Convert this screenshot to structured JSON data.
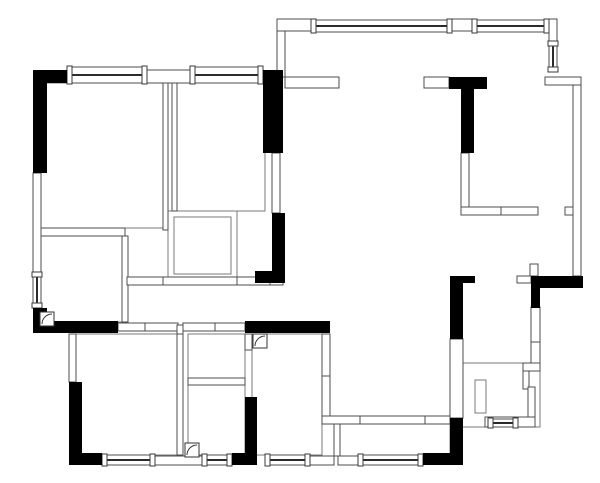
{
  "meta": {
    "type": "floor_plan",
    "description": "Black-and-white architectural apartment floor plan",
    "canvas_width": 600,
    "canvas_height": 483
  },
  "colors": {
    "background": "#ffffff",
    "solid_wall": "#000000",
    "partition_outline": "#4d4d4d",
    "room_outline": "#7a7a7a",
    "window_sash": "#2b2b2b",
    "door_line": "#333333"
  },
  "elements": {
    "solid_walls": [
      [
        33,
        70,
        34,
        13
      ],
      [
        33,
        70,
        14,
        103
      ],
      [
        263,
        70,
        20,
        83
      ],
      [
        272,
        213,
        13,
        70
      ],
      [
        255,
        271,
        30,
        12
      ],
      [
        449,
        77,
        38,
        12
      ],
      [
        461,
        89,
        13,
        64
      ],
      [
        33,
        308,
        14,
        25
      ],
      [
        33,
        321,
        85,
        12
      ],
      [
        245,
        321,
        85,
        12
      ],
      [
        69,
        382,
        13,
        83
      ],
      [
        69,
        453,
        33,
        12
      ],
      [
        232,
        453,
        24,
        12
      ],
      [
        245,
        397,
        12,
        68
      ],
      [
        423,
        453,
        40,
        12
      ],
      [
        450,
        418,
        13,
        47
      ],
      [
        450,
        276,
        13,
        63
      ],
      [
        463,
        276,
        12,
        7
      ],
      [
        531,
        276,
        52,
        12
      ],
      [
        531,
        288,
        9,
        20
      ]
    ],
    "partition_walls": [
      [
        147,
        70,
        43,
        13
      ],
      [
        33,
        173,
        8,
        99
      ],
      [
        277,
        19,
        34,
        12
      ],
      [
        452,
        19,
        20,
        12
      ],
      [
        549,
        19,
        8,
        22
      ],
      [
        545,
        77,
        36,
        8
      ],
      [
        573,
        85,
        8,
        191
      ],
      [
        565,
        207,
        8,
        8
      ],
      [
        277,
        31,
        8,
        46
      ],
      [
        285,
        77,
        54,
        11
      ],
      [
        424,
        77,
        25,
        11
      ],
      [
        461,
        153,
        8,
        54
      ],
      [
        461,
        207,
        40,
        8
      ],
      [
        501,
        207,
        37,
        8
      ],
      [
        272,
        153,
        8,
        60
      ],
      [
        450,
        339,
        13,
        79
      ],
      [
        163,
        83,
        5,
        147
      ],
      [
        172,
        83,
        5,
        128
      ],
      [
        41,
        228,
        84,
        8
      ],
      [
        122,
        236,
        6,
        86
      ],
      [
        127,
        277,
        36,
        8
      ],
      [
        163,
        277,
        74,
        8
      ],
      [
        237,
        277,
        33,
        8
      ],
      [
        270,
        277,
        13,
        8
      ],
      [
        118,
        323,
        27,
        8
      ],
      [
        145,
        323,
        33,
        8
      ],
      [
        183,
        323,
        32,
        8
      ],
      [
        215,
        323,
        30,
        8
      ],
      [
        177,
        325,
        6,
        17
      ],
      [
        177,
        334,
        6,
        121
      ],
      [
        69,
        334,
        7,
        48
      ],
      [
        188,
        378,
        57,
        7
      ],
      [
        245,
        334,
        7,
        16
      ],
      [
        322,
        334,
        8,
        42
      ],
      [
        322,
        376,
        8,
        42
      ],
      [
        322,
        416,
        38,
        8
      ],
      [
        360,
        416,
        65,
        8
      ],
      [
        425,
        416,
        25,
        8
      ],
      [
        334,
        424,
        6,
        32
      ],
      [
        155,
        456,
        47,
        9
      ],
      [
        310,
        456,
        24,
        9
      ],
      [
        338,
        456,
        20,
        9
      ],
      [
        531,
        307,
        9,
        35
      ],
      [
        531,
        342,
        9,
        23
      ],
      [
        523,
        363,
        17,
        8
      ],
      [
        523,
        371,
        6,
        18
      ],
      [
        528,
        387,
        7,
        30
      ],
      [
        485,
        417,
        50,
        10
      ],
      [
        530,
        264,
        8,
        12
      ],
      [
        517,
        276,
        14,
        7
      ]
    ],
    "room_outlines": [
      [
        40,
        83,
        123,
        145
      ],
      [
        177,
        83,
        88,
        128
      ],
      [
        168,
        211,
        69,
        69
      ],
      [
        174,
        217,
        57,
        57
      ],
      [
        41,
        236,
        81,
        86
      ],
      [
        76,
        334,
        101,
        121
      ],
      [
        188,
        334,
        57,
        44
      ],
      [
        188,
        385,
        57,
        70
      ],
      [
        252,
        334,
        70,
        121
      ],
      [
        334,
        424,
        116,
        32
      ],
      [
        457,
        363,
        83,
        64
      ],
      [
        475,
        380,
        11,
        33
      ]
    ],
    "windows_horizontal": [
      [
        67,
        67,
        80,
        16
      ],
      [
        190,
        67,
        73,
        16
      ],
      [
        311,
        20,
        141,
        12
      ],
      [
        472,
        20,
        77,
        12
      ],
      [
        102,
        455,
        53,
        10
      ],
      [
        202,
        455,
        30,
        10
      ],
      [
        265,
        455,
        45,
        10
      ],
      [
        358,
        455,
        65,
        10
      ],
      [
        488,
        419,
        30,
        8
      ]
    ],
    "windows_vertical": [
      [
        33,
        272,
        8,
        36
      ],
      [
        549,
        41,
        8,
        31
      ]
    ],
    "doors": [
      [
        40,
        312,
        14
      ],
      [
        253,
        334,
        14
      ],
      [
        185,
        443,
        14
      ]
    ]
  }
}
